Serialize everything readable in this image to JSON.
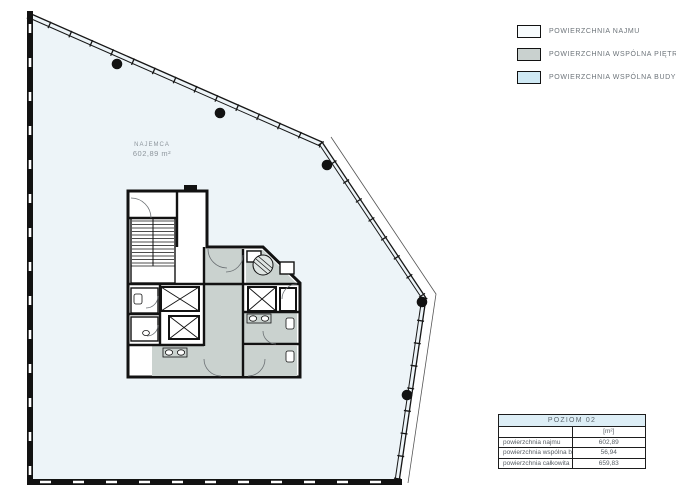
{
  "legend": {
    "items": [
      {
        "label": "POWIERZCHNIA NAJMU",
        "color": "#f7fbfd"
      },
      {
        "label": "POWIERZCHNIA WSPÓLNA PIĘTRA",
        "color": "#c9d1cf"
      },
      {
        "label": "POWIERZCHNIA WSPÓLNA BUDYNKU",
        "color": "#cfe9f4"
      }
    ]
  },
  "plan": {
    "tenant_label": "NAJEMCA",
    "tenant_area": "602,89 m²"
  },
  "table": {
    "header": "POZIOM 02",
    "unit_header": "[m²]",
    "rows": [
      {
        "label": "powierzchnia najmu",
        "value": "602,89"
      },
      {
        "label": "powierzchnia wspólna budynku",
        "value": "56,94"
      },
      {
        "label": "powierzchnia całkowita",
        "value": "659,83"
      }
    ]
  },
  "colors": {
    "floor_fill": "#edf4f8",
    "common_floor": "#cad2cf",
    "common_building": "#cfe9f4",
    "table_header_bg": "#ddeef6",
    "wall": "#121212"
  }
}
